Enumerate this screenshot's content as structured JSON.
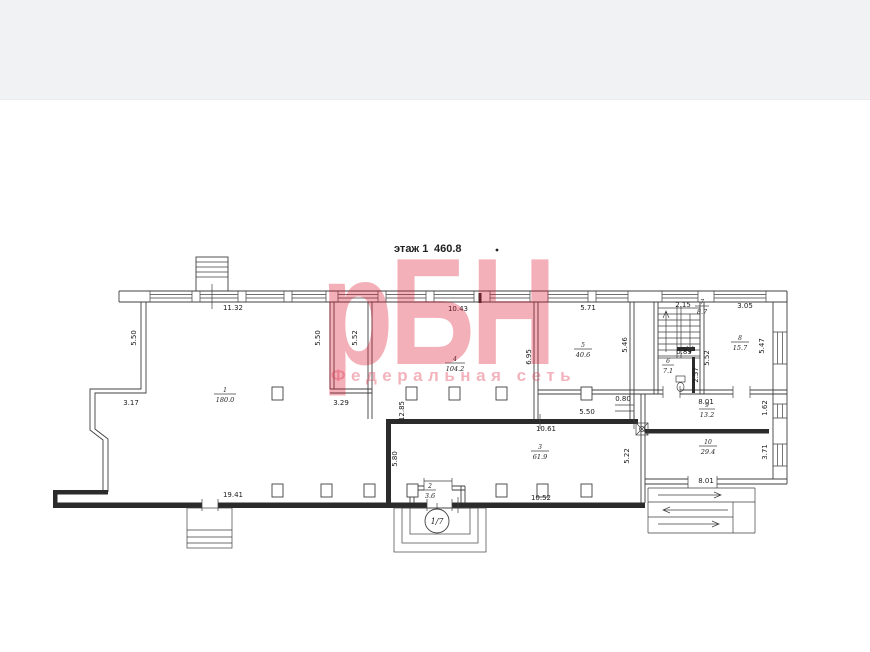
{
  "title": {
    "floor": "этаж 1",
    "area": "460.8"
  },
  "watermark": {
    "logo": "рБН",
    "tagline": "Федеральная сеть"
  },
  "section_mark": "1/7",
  "rooms": [
    {
      "num": "1",
      "area": "180.0"
    },
    {
      "num": "2",
      "area": "3.6"
    },
    {
      "num": "3",
      "area": "61.9"
    },
    {
      "num": "4",
      "area": "104.2"
    },
    {
      "num": "5",
      "area": "40.6"
    },
    {
      "num": "6",
      "area": "7.1"
    },
    {
      "num": "7",
      "area": "8.7"
    },
    {
      "num": "8",
      "area": "15.7"
    },
    {
      "num": "9",
      "area": "13.2"
    },
    {
      "num": "10",
      "area": "29.4"
    }
  ],
  "dims": {
    "top_room1": "11.32",
    "top_room4": "10.43",
    "top_room5": "5.71",
    "top_stair": "2.15",
    "top_room8": "3.05",
    "room1_left": "5.50",
    "strip_left": "5.50",
    "strip_right": "5.52",
    "step_left": "3.17",
    "strip_bottom": "3.29",
    "mid_height": "12.85",
    "room4_right": "6.95",
    "room5_right": "5.46",
    "stair_right": "5.52",
    "room8_right": "5.47",
    "stair_win": "0.89",
    "room6_height": "2.57",
    "niche": "0.80",
    "room9_top": "8.01",
    "room9_right": "1.62",
    "opening_mid": "5.50",
    "room3_top": "10.61",
    "room3_left": "5.80",
    "room3_right": "5.22",
    "room10_right": "3.71",
    "room10_bottom": "8.01",
    "bottom_left": "19.41",
    "room3_bottom": "10.52"
  }
}
